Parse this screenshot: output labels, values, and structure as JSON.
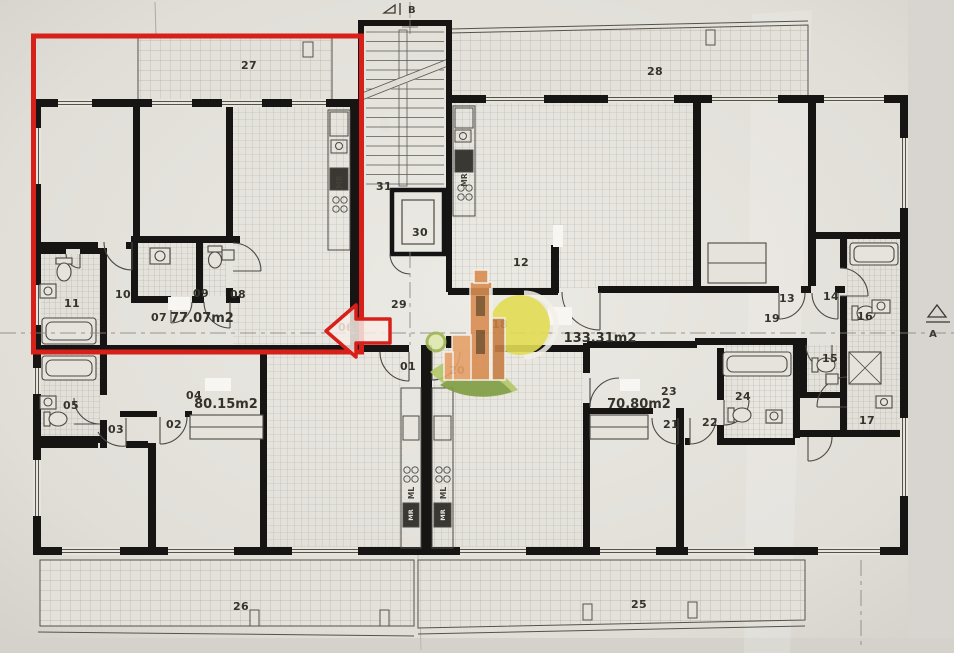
{
  "plan": {
    "rooms": {
      "r01": "01",
      "r02": "02",
      "r03": "03",
      "r04": "04",
      "r05": "05",
      "r06": "06",
      "r07": "07",
      "r08": "08",
      "r09": "09",
      "r10": "10",
      "r11": "11",
      "r12": "12",
      "r13": "13",
      "r14": "14",
      "r15": "15",
      "r16": "16",
      "r17": "17",
      "r18": "18",
      "r19": "19",
      "r20": "20",
      "r21": "21",
      "r22": "22",
      "r23": "23",
      "r24": "24",
      "r25": "25",
      "r26": "26",
      "r27": "27",
      "r28": "28",
      "r29": "29",
      "r30": "30",
      "r31": "31"
    },
    "areas": {
      "apt_top_left": "77.07m2",
      "apt_bottom_left": "80.15m2",
      "apt_top_right": "133.31m2",
      "apt_bottom_right": "70.80m2"
    },
    "kitchen_labels": {
      "top_left_mr": "MR",
      "top_right_mr": "MR",
      "bottom_left_ml": "ML",
      "bottom_left_mr": "MR",
      "bottom_right_ml": "ML",
      "bottom_right_mr": "MR"
    },
    "section_markers": {
      "top": "B",
      "right": "A"
    },
    "annotation": {
      "highlight_color": "#d8201a"
    }
  }
}
